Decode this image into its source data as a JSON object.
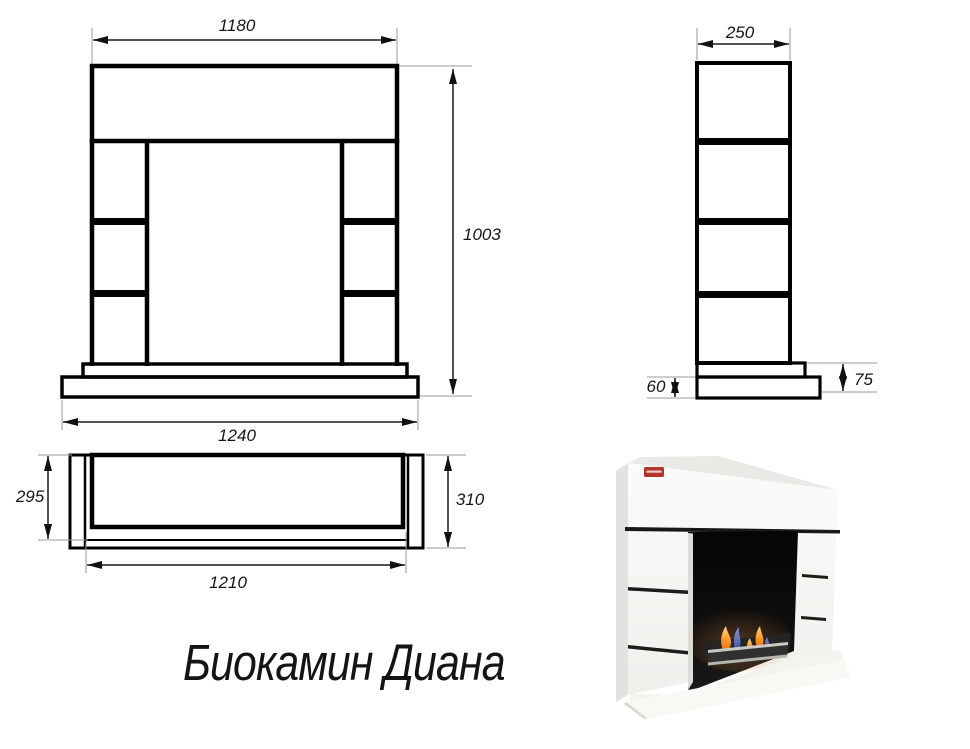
{
  "title": "Биокамин Диана",
  "front_view": {
    "dim_top_width": "1180",
    "dim_height": "1003",
    "dim_base_width": "1240"
  },
  "side_view": {
    "dim_top_depth": "250",
    "dim_plinth_lower": "60",
    "dim_plinth_total": "75"
  },
  "top_view": {
    "dim_inner_depth": "295",
    "dim_outer_depth": "310",
    "dim_inner_width": "1210"
  },
  "photo": {
    "brand_badge_color": "#b5342a",
    "body_color": "#f7f7f4",
    "firebox_color": "#0a0a0a",
    "flame_orange": "#ff9b30",
    "flame_blue": "#4b63d2"
  }
}
